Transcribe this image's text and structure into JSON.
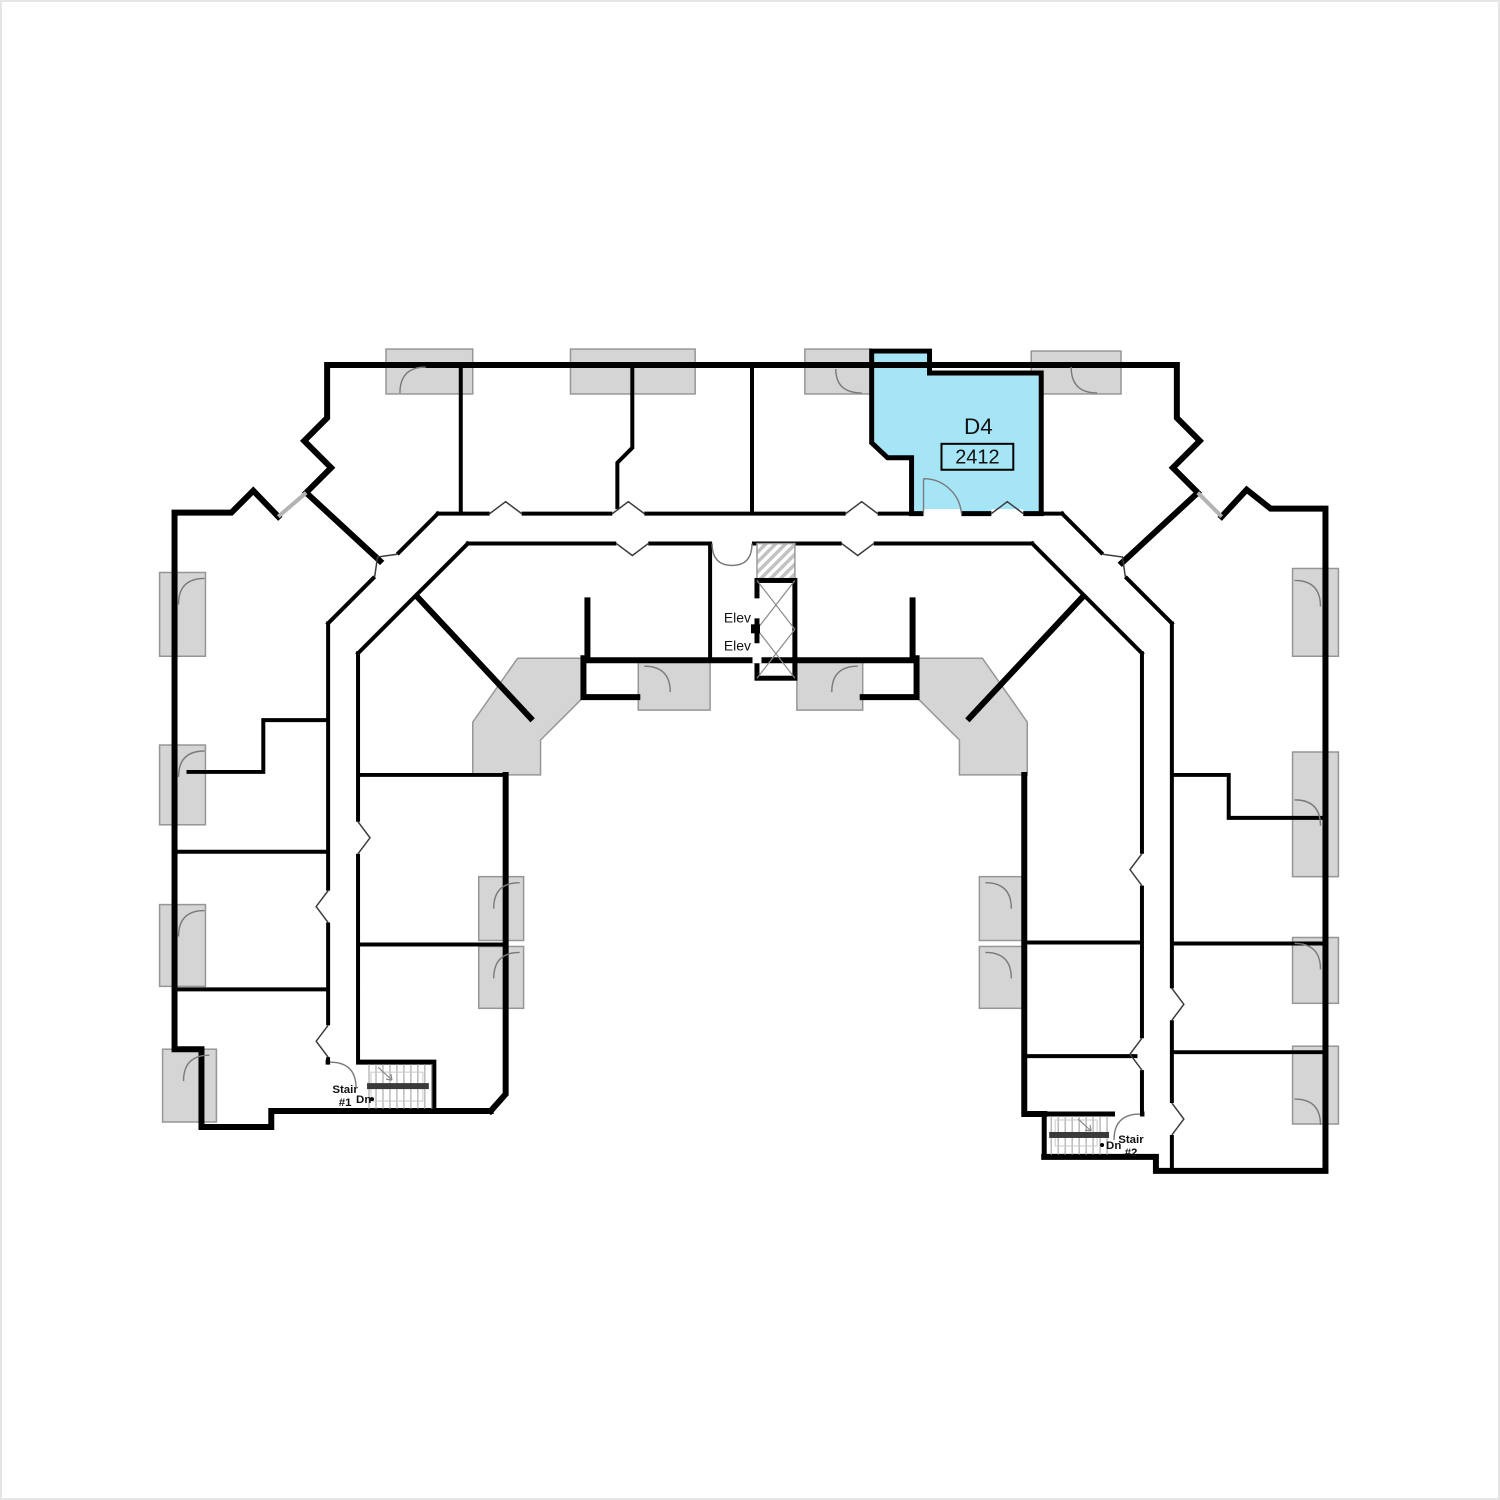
{
  "floor_plan": {
    "highlighted_unit": {
      "plan_code": "D4",
      "unit_number": "2412"
    },
    "elevator": {
      "labels": [
        "Elev",
        "Elev"
      ]
    },
    "stairs": [
      {
        "line1": "Stair",
        "line2": "#1",
        "down_label": "Dn"
      },
      {
        "line1": "Stair",
        "line2": "#2",
        "down_label": "Dn"
      }
    ],
    "colors": {
      "highlight": "#a6e5f6",
      "deck": "#d5d5d5",
      "deck_outline": "#969696",
      "wall": "#000000",
      "background": "#ffffff"
    }
  }
}
